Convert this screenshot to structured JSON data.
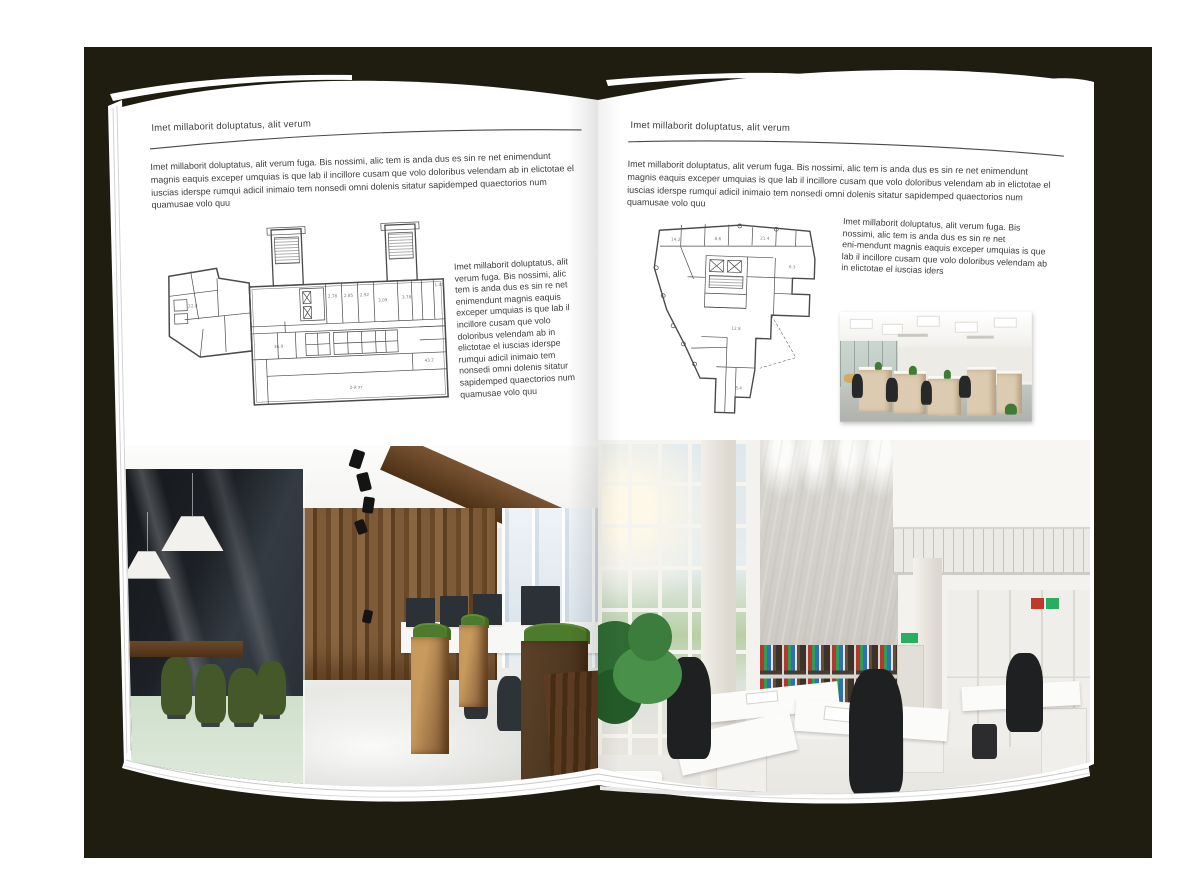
{
  "mockup": {
    "background_color": "#1e1d10",
    "page_color": "#ffffff",
    "text_color": "#3d3d3d",
    "rule_color": "#4a4a4a"
  },
  "left_page": {
    "header": "Imet millaborit doluptatus, alit verum",
    "intro": "Imet millaborit doluptatus, alit verum fuga. Bis nossimi, alic tem is anda dus es sin re net enimendunt magnis eaquis exceper umquias is que lab il incillore cusam que volo doloribus velendam ab in elictotae el iuscias iderspe rumqui adicil inimaio tem nonsedi omni dolenis sitatur sapidemped quaectorios num quamusae volo quu",
    "side_text": "Imet millaborit doluptatus, alit verum fuga. Bis nossimi, alic tem is anda dus es sin re net enimendunt magnis eaquis exceper umquias is que lab il incillore cusam que volo doloribus velendam ab in elictotae el iuscias iderspe rumqui adicil inimaio tem nonsedi omni dolenis sitatur sapidemped quaectorios num quamusae volo quu",
    "floor_plan": {
      "labels": [
        "2.78",
        "2.85",
        "2.92",
        "3.09",
        "3.78",
        "1.43",
        "22.8",
        "36.9",
        "43.2",
        "2-й эт"
      ]
    }
  },
  "right_page": {
    "header": "Imet millaborit doluptatus, alit verum",
    "intro": "Imet millaborit doluptatus, alit verum fuga. Bis nossimi, alic tem is anda dus es sin re net enimendunt magnis eaquis exceper umquias is que lab il incillore cusam que volo doloribus velendam ab in elictotae el iuscias iderspe rumqui adicil inimaio tem nonsedi omni dolenis sitatur sapidemped quaectorios num quamusae volo quu",
    "side_text": "Imet millaborit doluptatus, alit verum fuga. Bis nossimi, alic tem is anda dus es sin re net eni‑mendunt magnis eaquis exceper umquias is que lab il incillore cusam que volo doloribus velendam ab in elictotae el iuscias iders",
    "floor_plan": {
      "labels": [
        "14.2",
        "8.6",
        "21.4",
        "6.3",
        "12.8",
        "5.4"
      ]
    }
  }
}
